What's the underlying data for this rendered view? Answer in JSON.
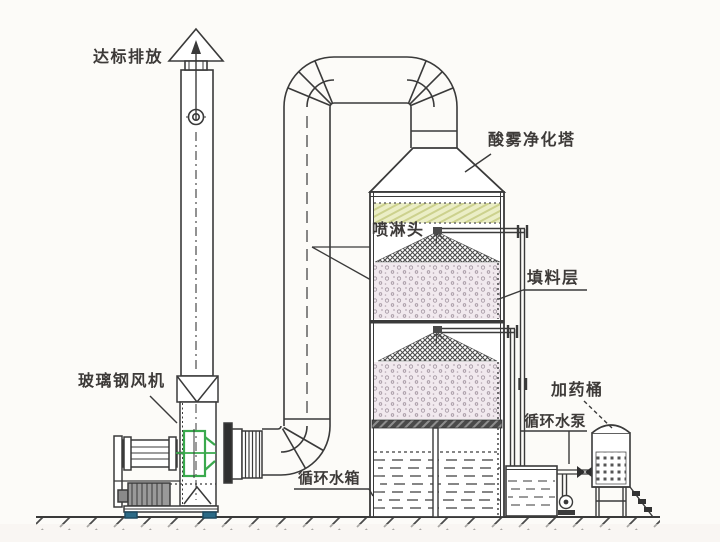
{
  "diagram": {
    "type": "engineering-schematic",
    "subject": "acid-mist-purification-tower-system"
  },
  "labels": {
    "emission": "达标排放",
    "tower": "酸雾净化塔",
    "spray_head": "喷淋头",
    "packing_layer": "填料层",
    "frp_fan": "玻璃钢风机",
    "circulating_tank": "循环水箱",
    "circulating_pump": "循环水泵",
    "dosing_barrel": "加药桶"
  },
  "colors": {
    "line": "#3a3a3a",
    "demister_band_fill": "#ebeec6",
    "demister_band_hatch": "#ccd18d",
    "packing_fill": "#f1e9ee",
    "packing_speckle": "#a295a0",
    "mound_hatch": "#4b4b4b",
    "fan_highlight_green": "#3aa94d",
    "foot_blue": "#2c6a86",
    "background": "#fcfbf8"
  }
}
